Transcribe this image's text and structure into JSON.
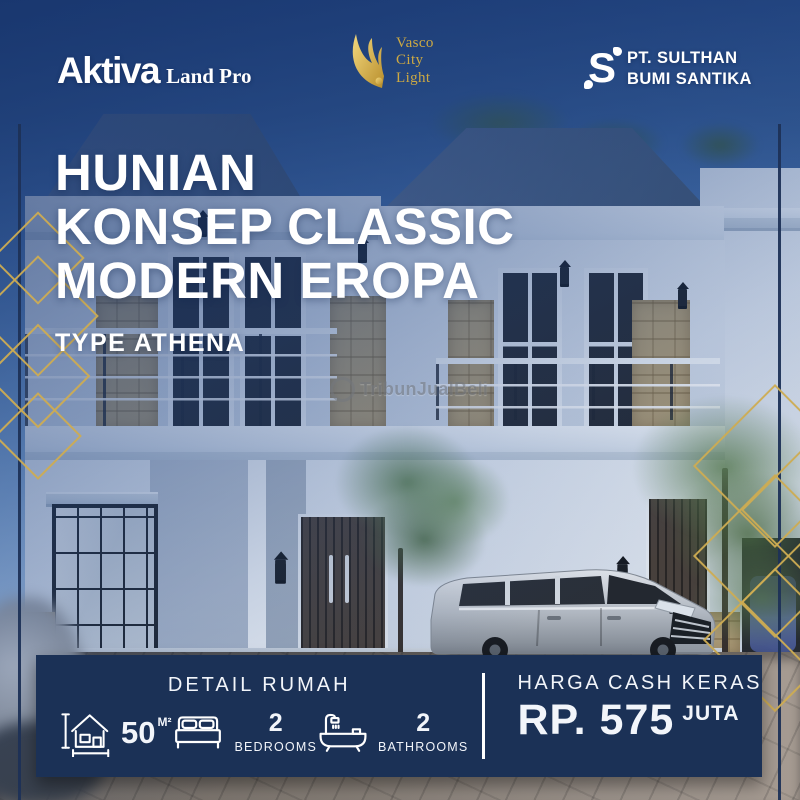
{
  "brand_bar": {
    "aktiva": {
      "name": "Aktiva",
      "suffix": "Land Pro"
    },
    "vasco": {
      "line1": "Vasco",
      "line2": "City",
      "line3": "Light"
    },
    "sulthan": {
      "mark": "S",
      "line1": "PT. SULTHAN",
      "line2": "BUMI SANTIKA"
    }
  },
  "headline": {
    "line1": "HUNIAN",
    "line2": "KONSEP CLASSIC",
    "line3": "MODERN EROPA",
    "subtitle": "TYPE ATHENA"
  },
  "watermark": {
    "text": "TribunJualBeli"
  },
  "detail_panel": {
    "title": "DETAIL RUMAH",
    "area": {
      "value": "50",
      "unit": "M²"
    },
    "bedrooms": {
      "value": "2",
      "label": "BEDROOMS"
    },
    "bathrooms": {
      "value": "2",
      "label": "BATHROOMS"
    }
  },
  "price_panel": {
    "label": "HARGA CASH KERAS",
    "currency": "RP.",
    "amount": "575",
    "unit": "JUTA"
  },
  "icons": {
    "wing": "wing-icon",
    "house_area": "house-measure-icon",
    "bed": "bed-icon",
    "bath": "bathtub-icon",
    "watermark_circle": "watermark-circle-icon"
  },
  "colors": {
    "navy": "#1b3156",
    "gold": "#c9a43e",
    "white": "#ffffff",
    "roof": "#4a5e7a"
  }
}
